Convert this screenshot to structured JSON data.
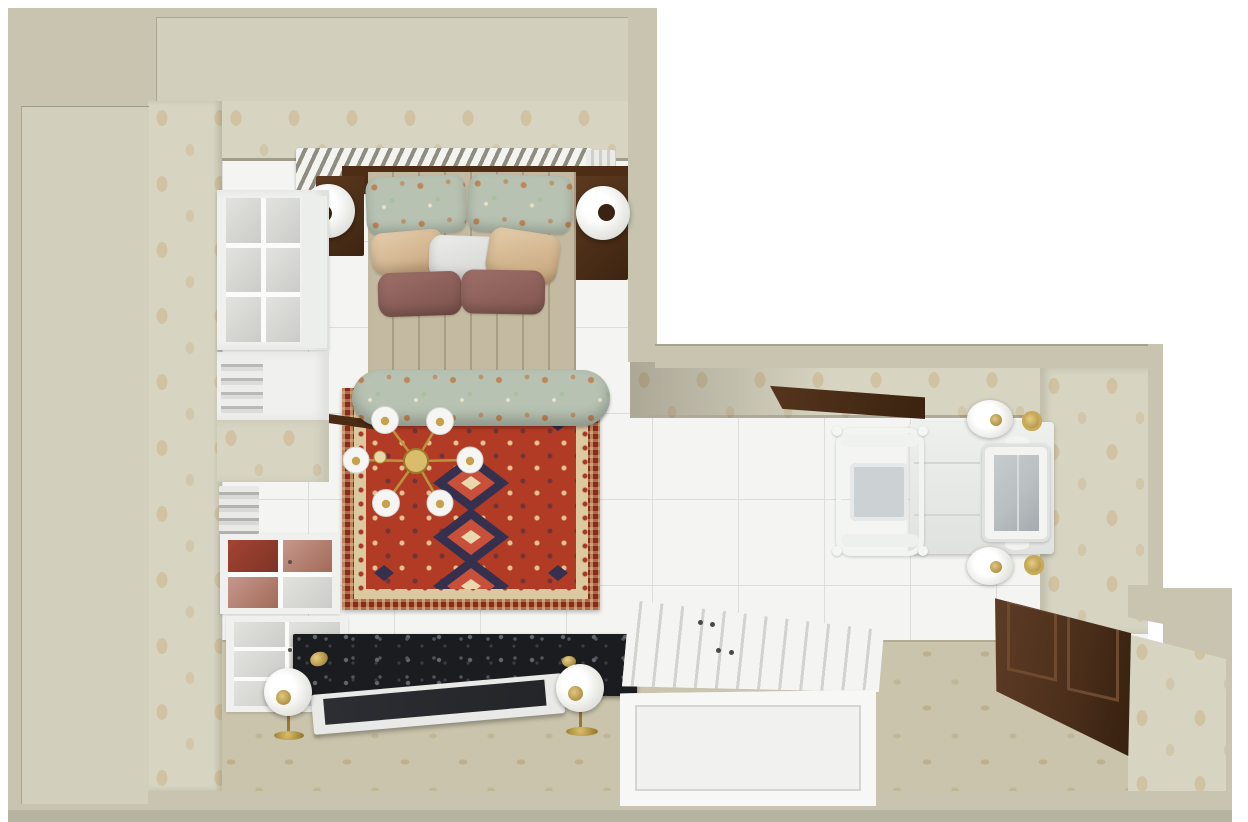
{
  "meta": {
    "kind": "3d-interior-floor-plan-render",
    "view": "top-down",
    "rooms": [
      "bedroom",
      "dressing-area"
    ]
  },
  "scene": {
    "items": {
      "tileFloor": "white tile floor",
      "carpetFloor": "beige patterned carpet",
      "wallpaper": "beige damask wallpaper",
      "radiator": "wall radiator",
      "bed": "double bed with quilted cover",
      "headboard": "dark wood headboard",
      "nightstandLeft": "left nightstand",
      "nightstandRight": "right nightstand",
      "lampLeft": "left bedside lamp",
      "lampRight": "right bedside lamp",
      "pillows": "floral, beige, white and mauve pillows",
      "bench": "floral bolster bench",
      "rug": "red oriental rug with diamond medallions",
      "chandelier": "six-globe brass chandelier",
      "hutch": "white glass-front hutch",
      "towelShelves": "open shelves with folded linens",
      "cabinetRed": "glass cabinet with red textile",
      "drawerChest": "white glass-front chest",
      "granite": "black granite low chest",
      "tv": "flat screen tv",
      "floorLampLeft": "left floor lamp",
      "floorLampRight": "right floor lamp",
      "daybed": "white paneled storage chest",
      "vanity": "white vanity table",
      "mirror": "vanity mirror",
      "chair": "carved white chair with grey cushion",
      "wallLampTop": "vanity wall lamp upper",
      "wallLampBottom": "vanity wall lamp lower",
      "saucers": "brass wall sconce plates",
      "woodCabinet": "dark wood cabinet",
      "lintel": "dark wood door lintel"
    }
  },
  "palette": {
    "wall": "#c8c4b0",
    "wall-light": "#d2cfbc",
    "wall-dark": "#b6b3a1",
    "wallpaper-base": "#d7d4c2",
    "wallpaper-motif-a": "#c9a87366",
    "wallpaper-motif-b": "#c9a8734d",
    "tile": "#f4f4f2",
    "tile-line": "#dcdcd8",
    "carpet": "#cac4ac",
    "carpet-motif-a": "#b2996e80",
    "carpet-motif-b": "#b2996e59",
    "quilt": "#c4baa2",
    "wood-dark": "#4e2d16",
    "floral-base": "#b7c2b2",
    "floral-accent": "#c0773fcc",
    "floral-accent-soft": "#c0773f99",
    "rug-red": "#b23b25",
    "rug-border": "#8a2b1a",
    "rug-cream": "#dcc9a0",
    "rug-navy": "#34304e",
    "granite": "#1b1c1f",
    "gold-deep": "#99782f",
    "mirror-glass": "#b9bfc1",
    "cushion": "#ccd1d3",
    "furn-white": "#f0f1ef",
    "glass-pane": "#e2e3df",
    "screen": "#232529",
    "red-fabric": "#a34433"
  }
}
